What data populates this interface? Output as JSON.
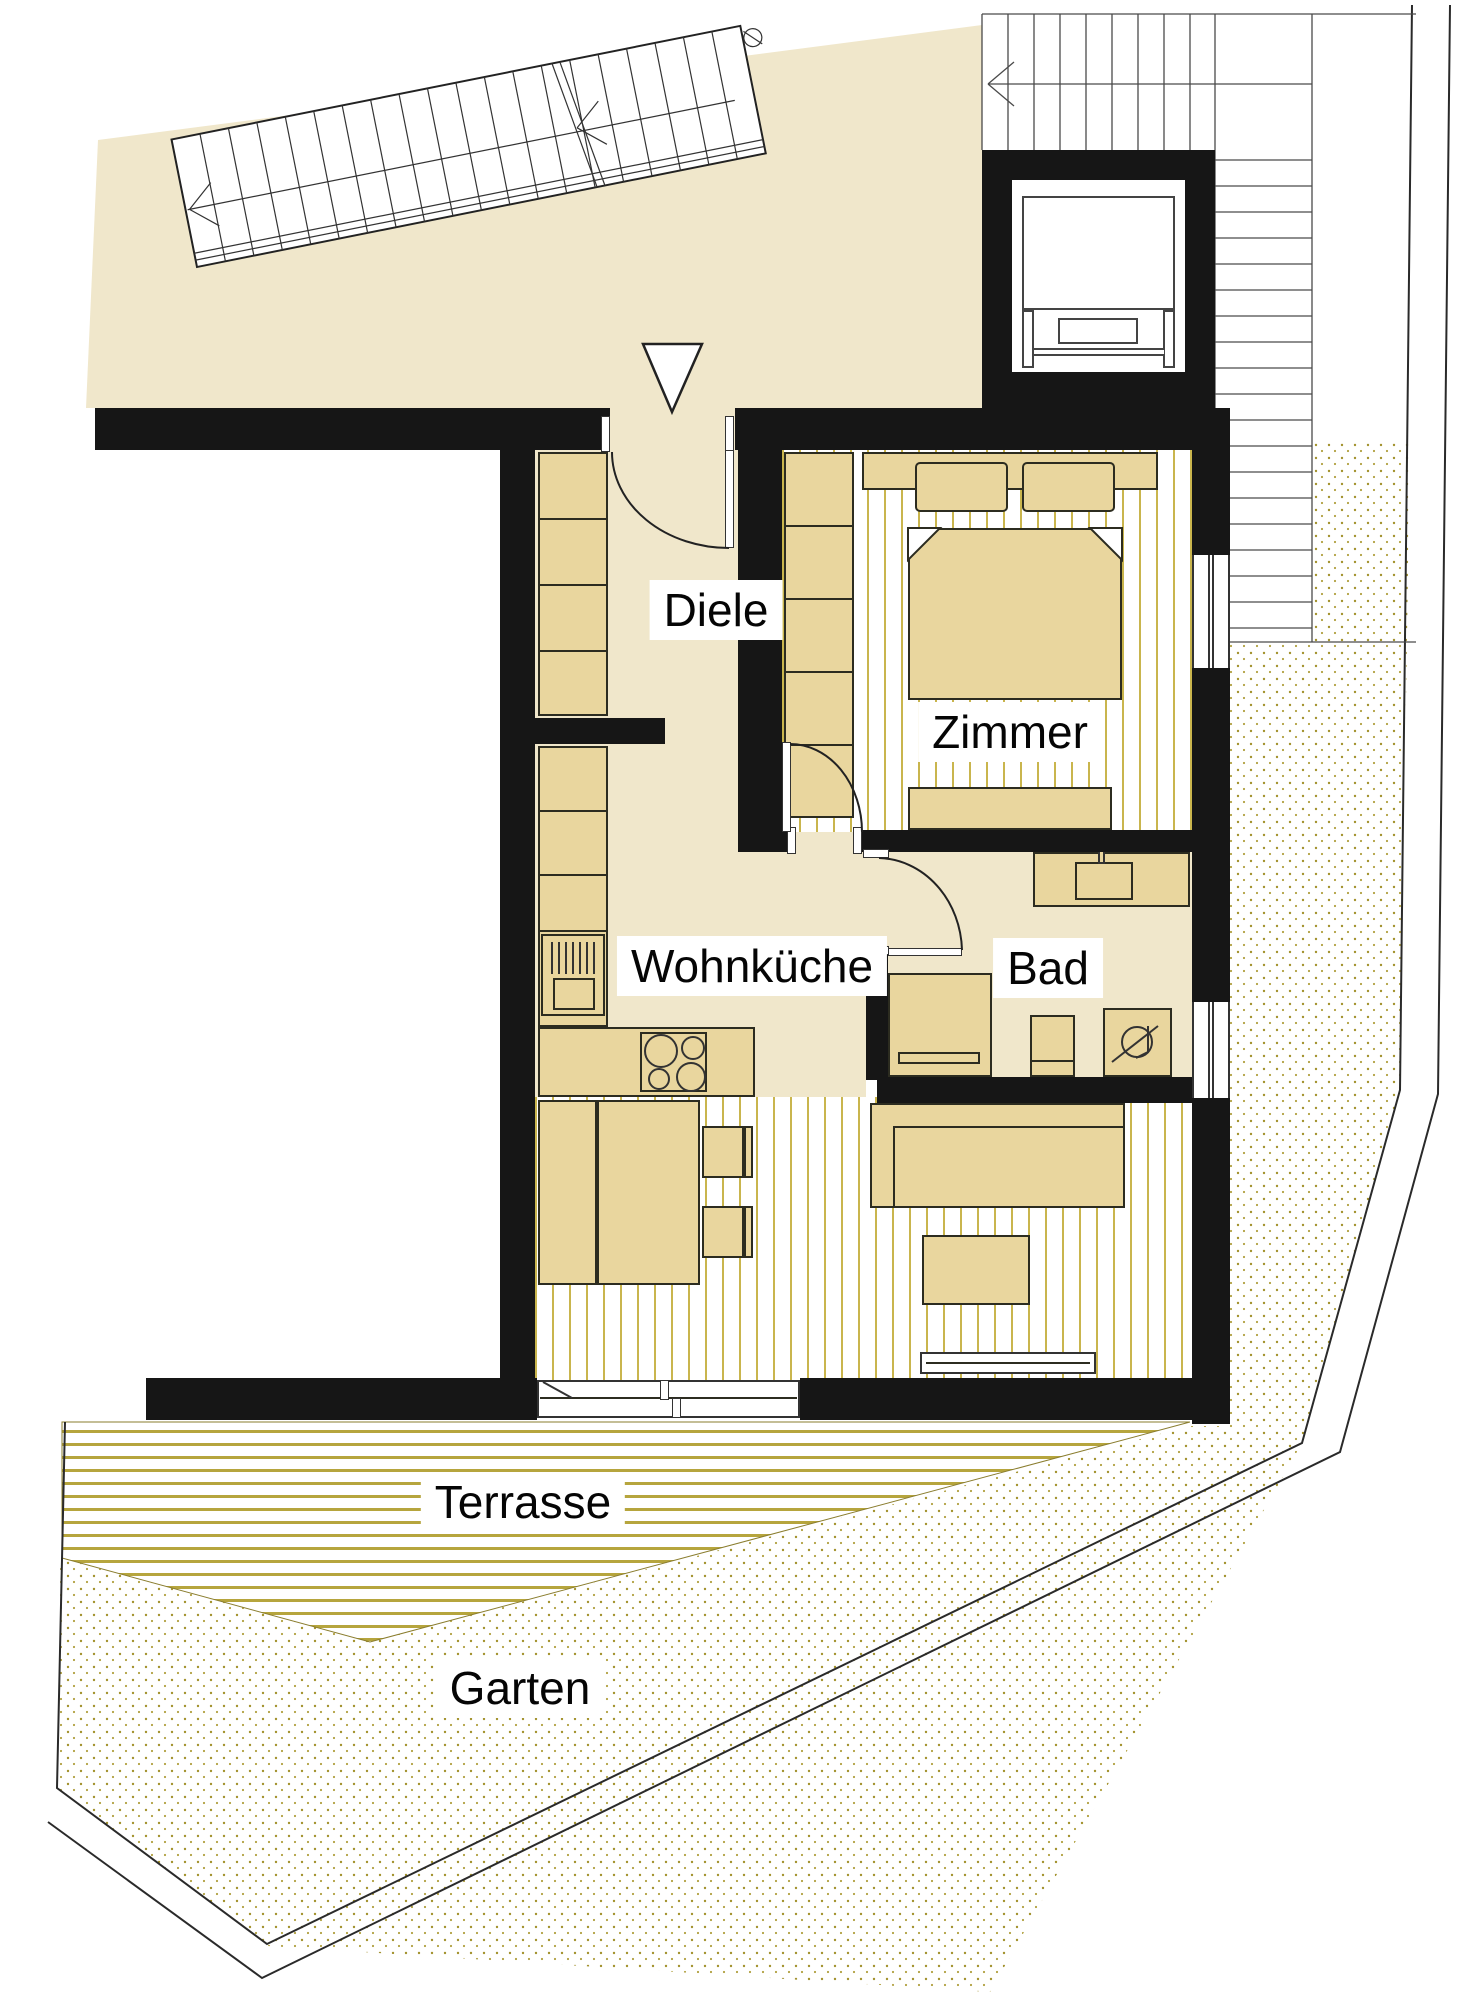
{
  "plan_labels": {
    "diele": "Diele",
    "zimmer": "Zimmer",
    "wohnkueche": "Wohnküche",
    "bad": "Bad",
    "terrasse": "Terrasse",
    "garten": "Garten"
  },
  "colors": {
    "floor_beige": "#f0e7cb",
    "furniture_tan": "#e9d69e",
    "wall_black": "#161616",
    "room_stripe_gold": "#c9b54d",
    "terrace_stripe_gold": "#b6a53d",
    "garden_dot_gold": "#a3922e",
    "stair_line_gray": "#4a4a4a"
  },
  "icons": {
    "entrance_marker": "triangle-down",
    "stair_direction_arrows": "chevron-left",
    "shower_drain": "swirl-circle"
  }
}
